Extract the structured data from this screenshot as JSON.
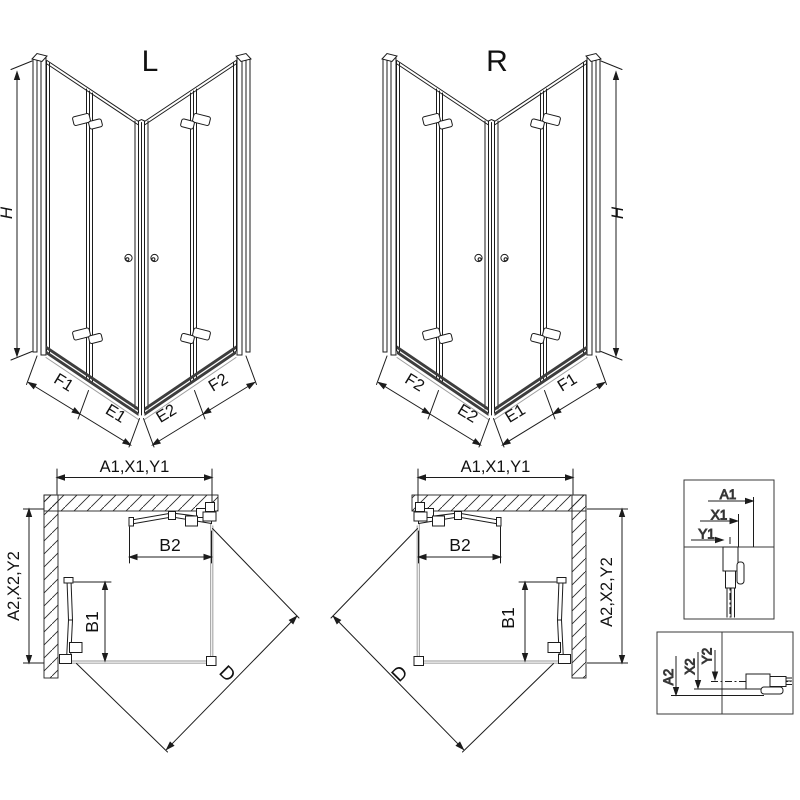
{
  "colors": {
    "line": "#1c1c1c",
    "tray_gray": "#ababab",
    "threshold_dark": "#3d3d3d",
    "label": "#111111",
    "background": "#ffffff"
  },
  "figures": {
    "perspective_left": {
      "title": "L",
      "height": "H",
      "seg_f1": "F1",
      "seg_e1": "E1",
      "seg_e2": "E2",
      "seg_f2": "F2"
    },
    "perspective_right": {
      "title": "R",
      "height": "H",
      "seg_f2": "F2",
      "seg_e2": "E2",
      "seg_e1": "E1",
      "seg_f1": "F1"
    },
    "plan_left": {
      "width_dim": "A1,X1,Y1",
      "depth_dim": "A2,X2,Y2",
      "door_width_dim": "B2",
      "door_depth_dim": "B1",
      "diagonal_dim": "D"
    },
    "plan_right": {
      "width_dim": "A1,X1,Y1",
      "depth_dim": "A2,X2,Y2",
      "door_width_dim": "B2",
      "door_depth_dim": "B1",
      "diagonal_dim": "D"
    },
    "detail_width": {
      "dim_a1": "A1",
      "dim_x1": "X1",
      "dim_y1": "Y1"
    },
    "detail_depth": {
      "dim_a2": "A2",
      "dim_x2": "X2",
      "dim_y2": "Y2"
    }
  }
}
